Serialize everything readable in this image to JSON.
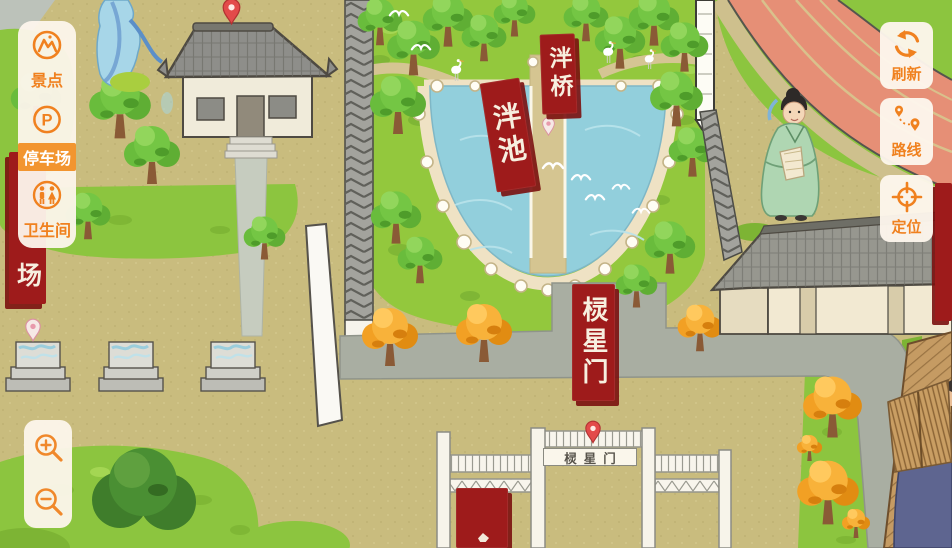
{
  "ui": {
    "sidebar": {
      "items": [
        {
          "id": "scenic",
          "label": "景点"
        },
        {
          "id": "parking",
          "label": "停车场",
          "icon_letter": "P",
          "active": true
        },
        {
          "id": "restroom",
          "label": "卫生间"
        }
      ]
    },
    "map_controls": [
      {
        "id": "refresh",
        "label": "刷新"
      },
      {
        "id": "route",
        "label": "路线"
      },
      {
        "id": "locate",
        "label": "定位"
      }
    ]
  },
  "map": {
    "banners": {
      "panchi": {
        "text": "泮池"
      },
      "panqiao": {
        "text": "泮桥"
      },
      "lingxingmen": {
        "text": "棂星门"
      },
      "parking_partial": {
        "text": "场"
      }
    },
    "gate_sign": "棂星门",
    "colors": {
      "accent_orange": "#F0811F",
      "banner_red": "#9E1B1B",
      "water_blue": "#92CFDC",
      "grass_green": "#8CC53F",
      "ground_tan": "#C9BC7E",
      "track_salmon": "#E68F76",
      "roof_grey": "#97978F"
    }
  }
}
